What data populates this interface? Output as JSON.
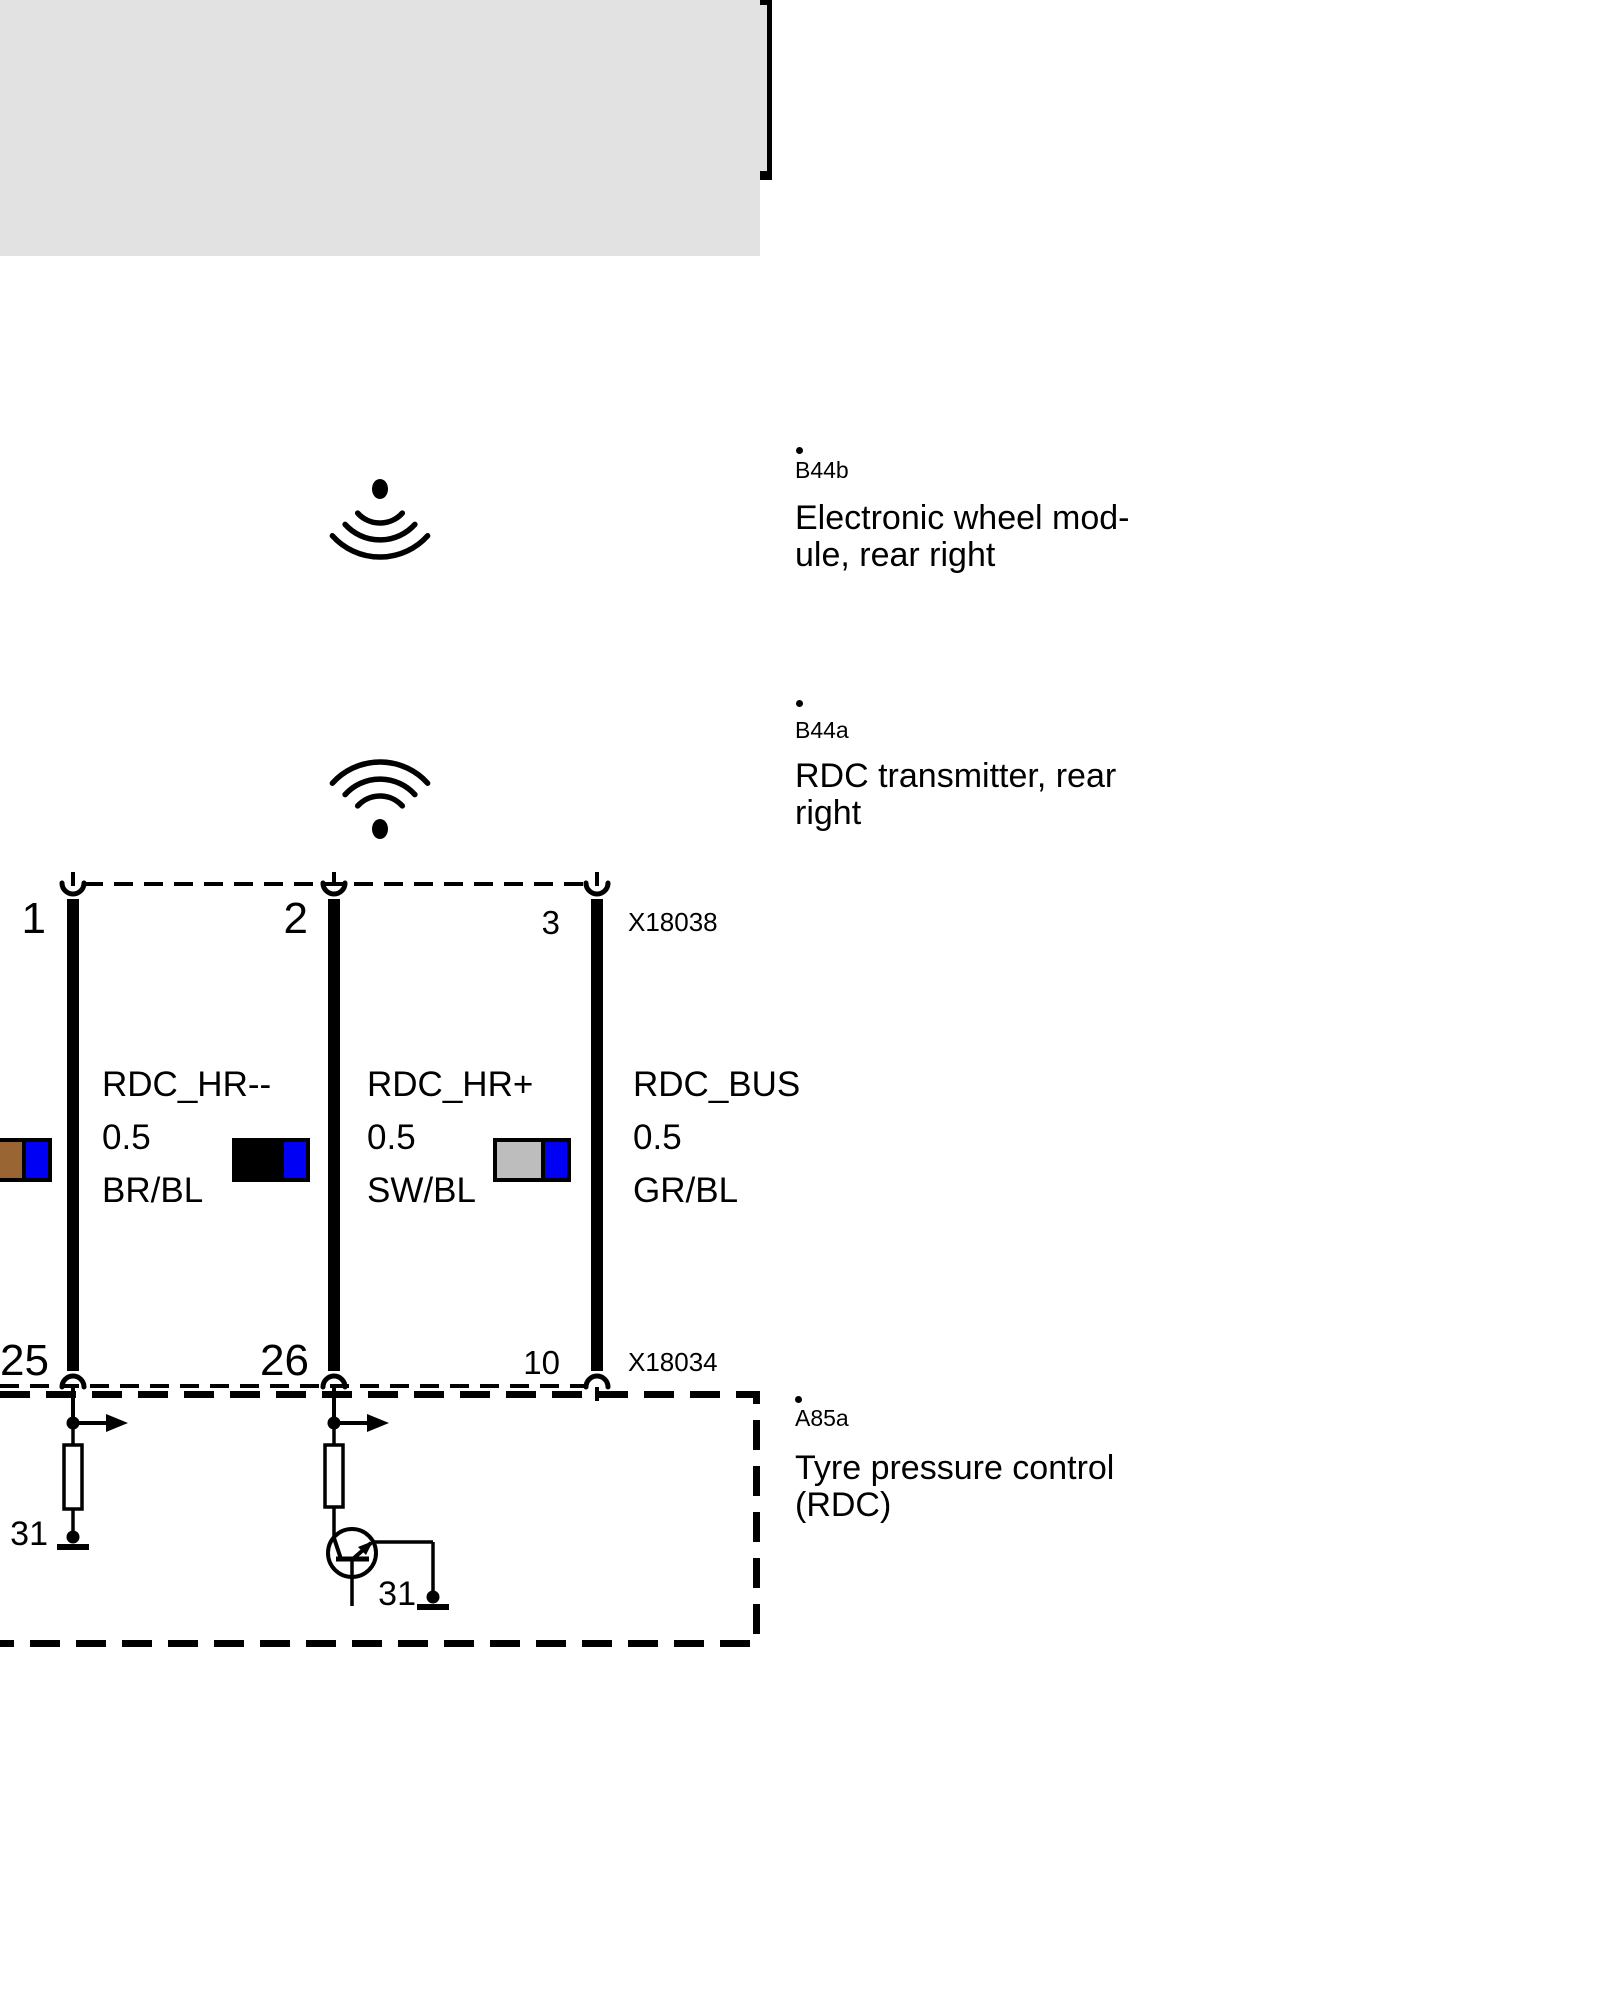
{
  "marker": {
    "color": "#e2001a"
  },
  "colors": {
    "module_fill": "#e2e2e2",
    "line": "#000000",
    "swatch_blue": "#0000f5",
    "swatch_gray": "#bdbdbd",
    "swatch_brown": "#996633",
    "swatch_black": "#000000"
  },
  "components": [
    {
      "dot": ".",
      "id": "B44b",
      "line1": "Electronic wheel mod-",
      "line2": "ule, rear right"
    },
    {
      "dot": ".",
      "id": "B44a",
      "line1": "RDC transmitter, rear",
      "line2": "right"
    },
    {
      "dot": ".",
      "id": "A85a",
      "line1": "Tyre pressure control",
      "line2": "(RDC)"
    }
  ],
  "connectors": [
    {
      "id": "X18038",
      "pins": [
        "1",
        "2",
        "3"
      ]
    },
    {
      "id": "X18034",
      "pins": [
        "25",
        "26",
        "10"
      ]
    }
  ],
  "wires": [
    {
      "signal": "RDC_HR--",
      "size": "0.5",
      "color_code": "BR/BL",
      "swatch": [
        "#996633",
        "#0000f5"
      ]
    },
    {
      "signal": "RDC_HR+",
      "size": "0.5",
      "color_code": "SW/BL",
      "swatch": [
        "#000000",
        "#0000f5"
      ]
    },
    {
      "signal": "RDC_BUS",
      "size": "0.5",
      "color_code": "GR/BL",
      "swatch": [
        "#bdbdbd",
        "#0000f5"
      ]
    }
  ],
  "grounds": [
    {
      "label": "31"
    },
    {
      "label": "31"
    }
  ]
}
